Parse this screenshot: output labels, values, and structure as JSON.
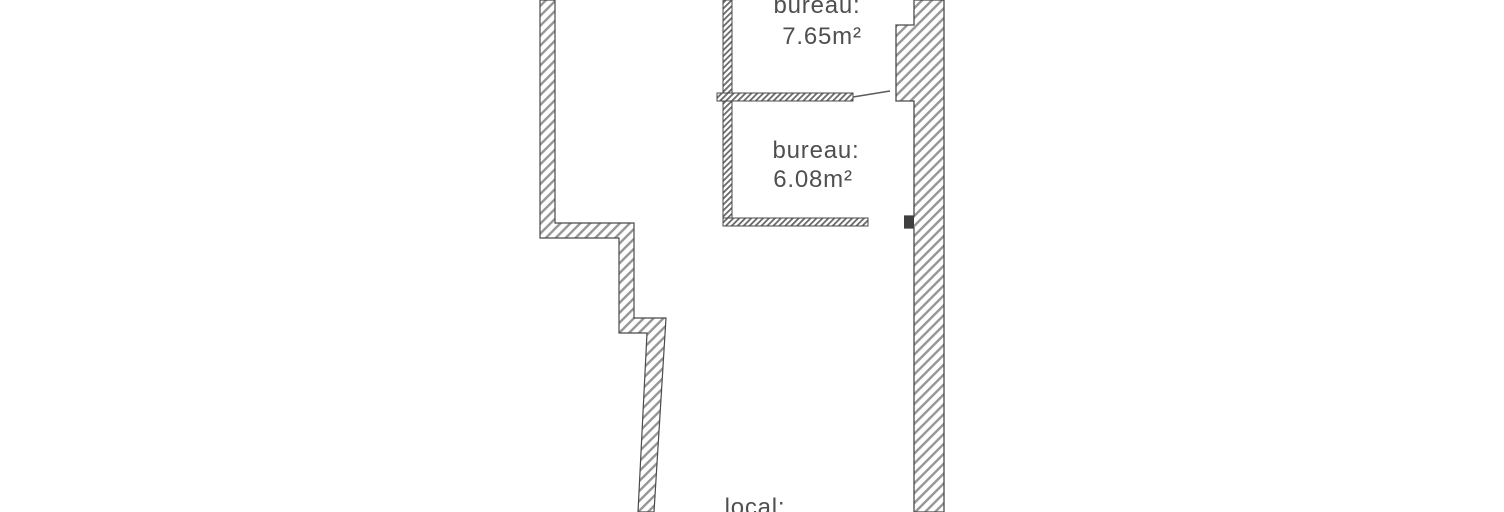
{
  "floorplan": {
    "rooms": [
      {
        "label": "bureau:",
        "area": "7.65m²"
      },
      {
        "label": "bureau:",
        "area": "6.08m²"
      },
      {
        "label": "local:"
      }
    ],
    "colors": {
      "background": "#ffffff",
      "wall_hatch": "#969696",
      "partition_hatch": "#6a6a6a",
      "wall_outline": "#4a4a4a",
      "label_text": "#4f4f4f"
    }
  }
}
